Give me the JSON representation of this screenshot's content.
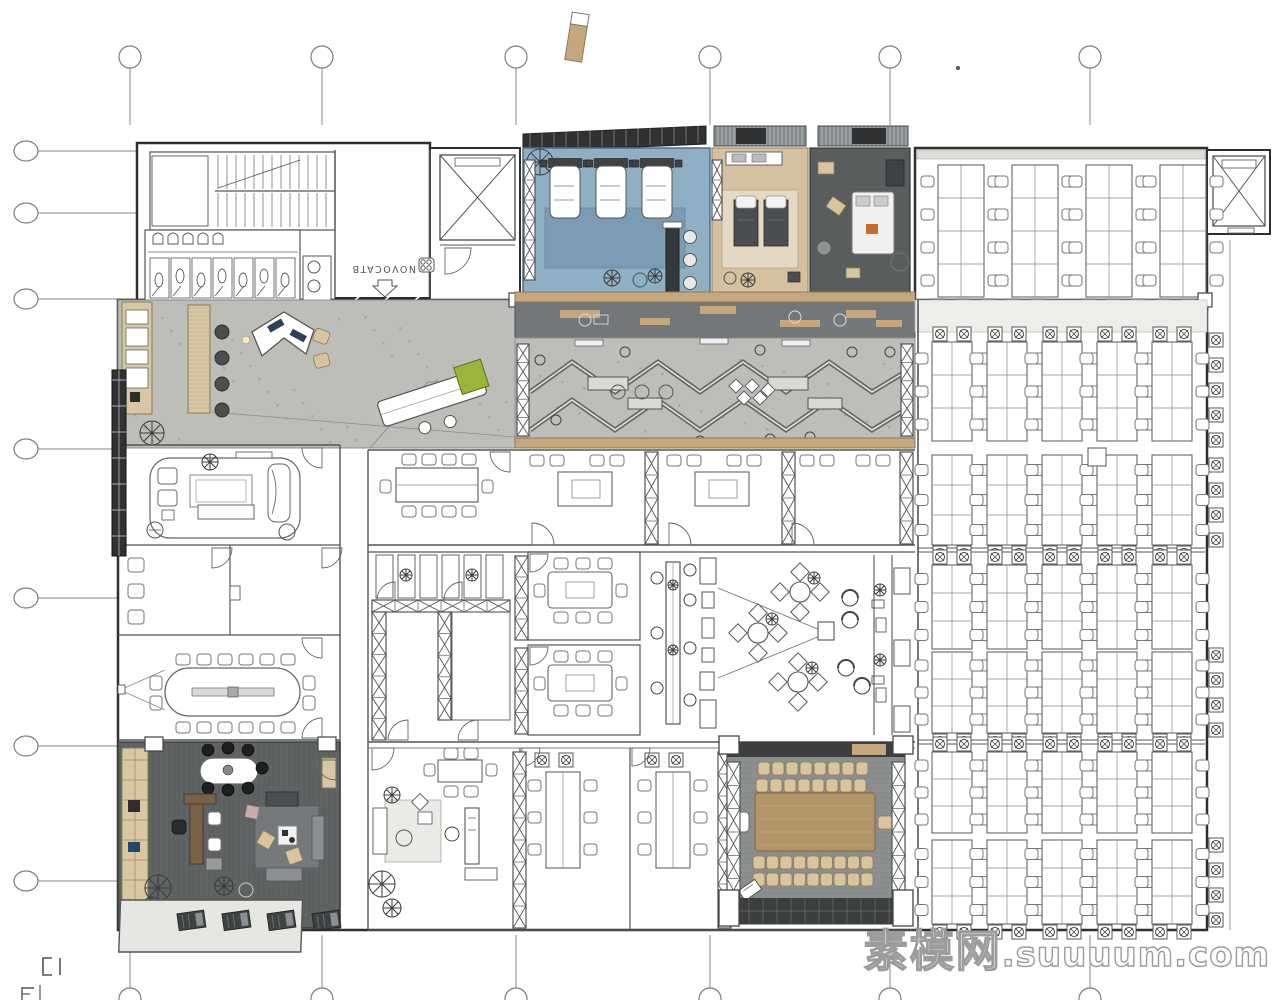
{
  "watermark": {
    "site_name_zh": "素模网",
    "site_domain": ".suuuum.com"
  },
  "entrance": {
    "brand_text": "NOVOCATB",
    "brand_logo": "four-dots-logo",
    "door_marker": "down-arrow"
  },
  "grid": {
    "top_column_count": 6,
    "bottom_column_count": 6,
    "left_row_count": 7
  },
  "colors": {
    "line": "#4a4a4a",
    "wall": "#2e2e2e",
    "blue_floor": "#8fafc4",
    "blue_rug": "#7b9cb3",
    "wood_trim": "#c6a77d",
    "wood_light": "#d8c6a4",
    "tan_floor": "#d5c1a0",
    "dark_floor": "#5a5e5f",
    "walkway": "#73777a",
    "corridor": "#bdbdb9",
    "corridor_dot": "#a8a8a4",
    "table_wood": "#b3956a",
    "chair_tan": "#d8c49d",
    "plant_green": "#9ab43c",
    "exec_floor": "#5f6364",
    "facade": "#2f3132",
    "awning": "#9aa0a2",
    "terrace": "#e6e6e2",
    "booth_dark": "#3f4243",
    "hall_floor": "#8b8f90"
  },
  "areas": [
    {
      "id": "stair-core",
      "label": "staircase"
    },
    {
      "id": "restrooms",
      "urinals": 5,
      "toilet_stalls": 7,
      "sinks": 2
    },
    {
      "id": "entrance-lobby",
      "brand": "NOVOCATB"
    },
    {
      "id": "elevator-west"
    },
    {
      "id": "elevator-northeast"
    },
    {
      "id": "relax-room-blue",
      "recliner_beds": 3,
      "bar_stools": 3
    },
    {
      "id": "nap-lounge-tan",
      "daybeds": 2
    },
    {
      "id": "nap-lounge-dark",
      "beds": 1
    },
    {
      "id": "open-office-north",
      "desk_clusters": 4,
      "seats_per_cluster": 8
    },
    {
      "id": "reception-lounge",
      "bar_stools": 4,
      "reception_desk": 1,
      "mobile_table": 1
    },
    {
      "id": "gallery-walkway"
    },
    {
      "id": "zigzag-collab-zone",
      "stools": 9
    },
    {
      "id": "meeting-room-10p",
      "seats": 10
    },
    {
      "id": "training-room-a",
      "seats": 4
    },
    {
      "id": "training-room-b",
      "seats": 4
    },
    {
      "id": "open-room-east",
      "seats": 4
    },
    {
      "id": "phone-booths",
      "count": 6
    },
    {
      "id": "flex-rooms",
      "count": 2
    },
    {
      "id": "meeting-room-8p-a",
      "seats": 8
    },
    {
      "id": "meeting-room-8p-b",
      "seats": 8
    },
    {
      "id": "cafe-lounge",
      "round_tables": 3,
      "high_table_stools": 7,
      "lounge_chairs": 4
    },
    {
      "id": "lounge-suite"
    },
    {
      "id": "quiet-room-a"
    },
    {
      "id": "quiet-room-b"
    },
    {
      "id": "conference-room-16p",
      "seats": 16
    },
    {
      "id": "executive-office",
      "terrace_loungers": 4
    },
    {
      "id": "studio-office",
      "dining_seats": 6
    },
    {
      "id": "meeting-room-6p-a",
      "seats": 6
    },
    {
      "id": "meeting-room-6p-b",
      "seats": 6
    },
    {
      "id": "conference-hall",
      "seats": 35
    },
    {
      "id": "open-office-east",
      "bank_rows": 6,
      "clusters_per_row": 5,
      "seats_per_cluster": 6
    }
  ]
}
